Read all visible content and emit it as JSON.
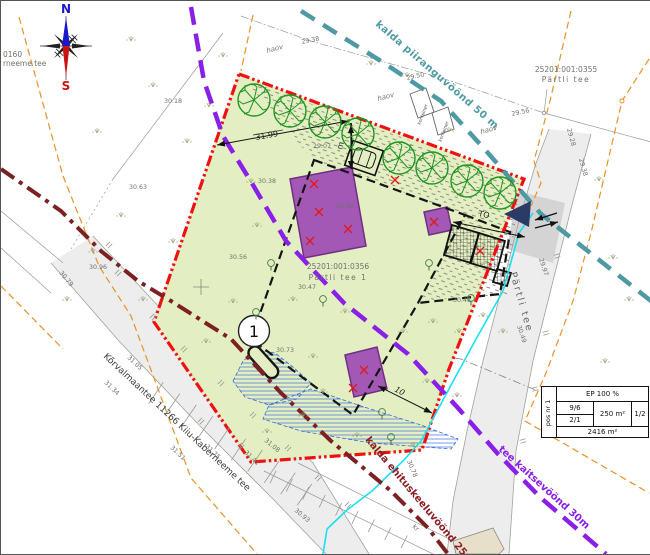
{
  "map": {
    "compass": {
      "north": "N",
      "south": "S"
    },
    "cadastral": {
      "top_left_code": "0160",
      "top_left_name": "rneeme tee",
      "neighbor_code": "25201:001:0355",
      "neighbor_name": "Pärtli tee",
      "plot_code": "25201:001:0356",
      "plot_name": "Pärtli tee 1"
    },
    "zones": {
      "shore_limit": {
        "label": "kalda piiranguvöönd 50 m",
        "color": "#4e99a3"
      },
      "road_protection": {
        "label": "tee kaitsevöönd 30m",
        "color": "#8a1fe8"
      },
      "shore_building_ban": {
        "label": "kalda ehituskeeluvöönd 25m",
        "color": "#8b2024"
      }
    },
    "roads": {
      "main_road": "Kõrvalmaantee 11266 Kiiu-Kaberneeme tee",
      "side_road": "Pärtli tee"
    },
    "position_number": "1",
    "dimensions": {
      "top_width": "31.99",
      "height_note": "m",
      "access": "TO",
      "south_gap": "10"
    },
    "annotations": {
      "yard_labels": [
        "haov",
        "haov",
        "haov"
      ],
      "container_label": "konteiner",
      "kr_label": "kr"
    },
    "elevations": [
      {
        "v": "30.18",
        "x": 163,
        "y": 102,
        "r": 0
      },
      {
        "v": "30.63",
        "x": 128,
        "y": 188,
        "r": 0
      },
      {
        "v": "29.38",
        "x": 301,
        "y": 43,
        "r": -12
      },
      {
        "v": "29.50",
        "x": 406,
        "y": 79,
        "r": -12
      },
      {
        "v": "29.56",
        "x": 511,
        "y": 115,
        "r": -12
      },
      {
        "v": "29.07",
        "x": 312,
        "y": 147,
        "r": 0
      },
      {
        "v": "30.38",
        "x": 257,
        "y": 182,
        "r": 0
      },
      {
        "v": "30.86",
        "x": 335,
        "y": 207,
        "r": 0
      },
      {
        "v": "30.56",
        "x": 228,
        "y": 258,
        "r": 0
      },
      {
        "v": "30.47",
        "x": 297,
        "y": 288,
        "r": 0
      },
      {
        "v": "30.48",
        "x": 452,
        "y": 301,
        "r": 0
      },
      {
        "v": "30.73",
        "x": 275,
        "y": 351,
        "r": 0
      },
      {
        "v": "30.96",
        "x": 88,
        "y": 268,
        "r": 0
      },
      {
        "v": "30.79",
        "x": 58,
        "y": 272,
        "r": 50
      },
      {
        "v": "31.05",
        "x": 126,
        "y": 357,
        "r": 44
      },
      {
        "v": "31.34",
        "x": 103,
        "y": 382,
        "r": 44
      },
      {
        "v": "31.51",
        "x": 169,
        "y": 447,
        "r": 44
      },
      {
        "v": "31.75",
        "x": 204,
        "y": 446,
        "r": 44
      },
      {
        "v": "31.41",
        "x": 243,
        "y": 452,
        "r": 44
      },
      {
        "v": "31.08",
        "x": 263,
        "y": 440,
        "r": 40
      },
      {
        "v": "30.93",
        "x": 293,
        "y": 510,
        "r": 40
      },
      {
        "v": "30.78",
        "x": 406,
        "y": 460,
        "r": 68
      },
      {
        "v": "30.49",
        "x": 516,
        "y": 325,
        "r": 72
      },
      {
        "v": "29.97",
        "x": 538,
        "y": 258,
        "r": 72
      },
      {
        "v": "29.28",
        "x": 566,
        "y": 128,
        "r": 75
      },
      {
        "v": "29.38",
        "x": 578,
        "y": 158,
        "r": 75
      }
    ],
    "info_table": {
      "pos": "pos nr 1",
      "top": "EP 100 %",
      "storeys": "9/6",
      "units": "2/1",
      "area": "250 m²",
      "ratio": "1/2",
      "plot_area": "2416 m²"
    }
  }
}
